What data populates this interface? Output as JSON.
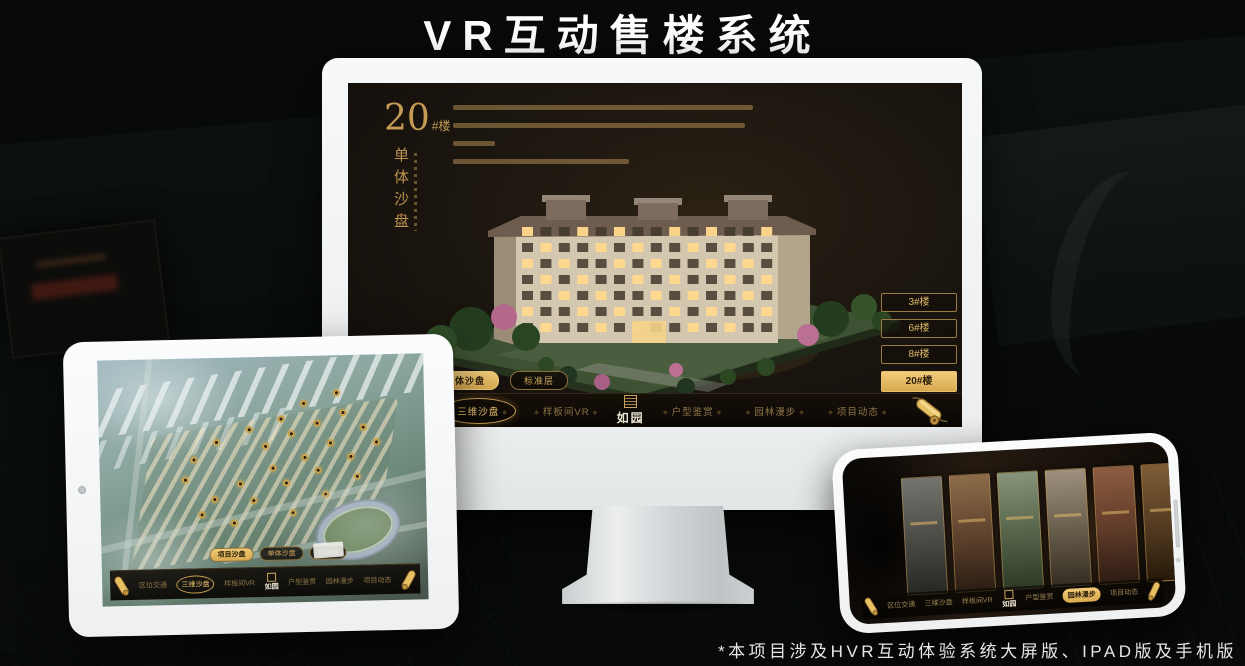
{
  "page": {
    "title": "VR互动售楼系统",
    "footer_note": "*本项目涉及HVR互动体验系统大屏版、IPAD版及手机版"
  },
  "brand": {
    "logo_text": "如园"
  },
  "colors": {
    "gold": "#d9b264",
    "gold_bright": "#eecb7c",
    "gold_dim": "#8d7648",
    "screen_bg": "#1c1610",
    "device_body": "#f2f4f5"
  },
  "monitor": {
    "heading": {
      "number": "20",
      "suffix": "#楼",
      "subtitle": "单体沙盘"
    },
    "floor_buttons": [
      {
        "label": "3#楼",
        "active": false
      },
      {
        "label": "6#楼",
        "active": false
      },
      {
        "label": "8#楼",
        "active": false
      },
      {
        "label": "20#楼",
        "active": true
      }
    ],
    "tabs": [
      {
        "label": "项目沙盘",
        "active": false
      },
      {
        "label": "单体沙盘",
        "active": true
      },
      {
        "label": "标准层",
        "active": false
      }
    ],
    "nav_items": [
      {
        "label": "区位交通",
        "active": false
      },
      {
        "label": "三维沙盘",
        "active": true
      },
      {
        "label": "样板间VR",
        "active": false
      },
      {
        "label": "户型鉴赏",
        "active": false
      },
      {
        "label": "园林漫步",
        "active": false
      },
      {
        "label": "项目动态",
        "active": false
      }
    ]
  },
  "tablet": {
    "tabs": [
      {
        "label": "项目沙盘",
        "active": true
      },
      {
        "label": "单体沙盘",
        "active": false
      },
      {
        "label": "标准层",
        "active": false
      }
    ],
    "nav_items": [
      {
        "label": "区位交通",
        "active": false
      },
      {
        "label": "三维沙盘",
        "active": true
      },
      {
        "label": "样板间VR",
        "active": false
      },
      {
        "label": "户型鉴赏",
        "active": false
      },
      {
        "label": "园林漫步",
        "active": false
      },
      {
        "label": "项目动态",
        "active": false
      }
    ]
  },
  "phone": {
    "nav_items": [
      {
        "label": "区位交通",
        "active": false
      },
      {
        "label": "三维沙盘",
        "active": false
      },
      {
        "label": "样板间VR",
        "active": false
      },
      {
        "label": "户型鉴赏",
        "active": false
      },
      {
        "label": "园林漫步",
        "active": true
      },
      {
        "label": "项目动态",
        "active": false
      }
    ]
  }
}
